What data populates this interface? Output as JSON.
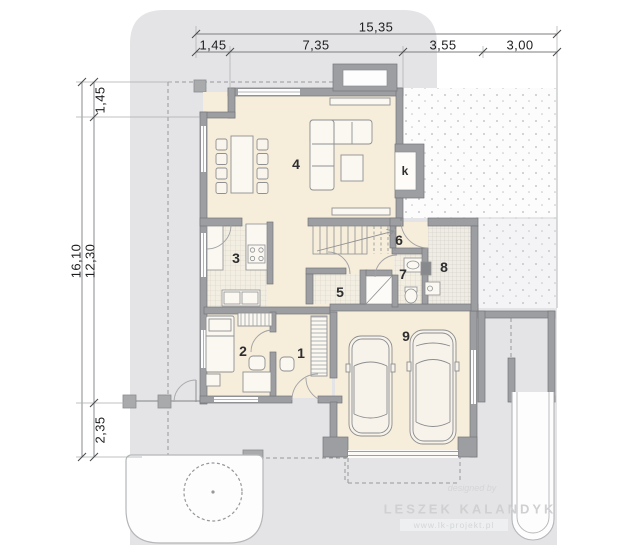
{
  "plan": {
    "dim_top": {
      "total": "15,35",
      "segments": [
        "1,45",
        "7,35",
        "3,55",
        "3,00"
      ]
    },
    "dim_left": {
      "total": "16,10",
      "upper": "1,45",
      "middle": "12,30",
      "lower": "2,35"
    },
    "rooms": [
      {
        "label": "1"
      },
      {
        "label": "2"
      },
      {
        "label": "3"
      },
      {
        "label": "4"
      },
      {
        "label": "5"
      },
      {
        "label": "6"
      },
      {
        "label": "7"
      },
      {
        "label": "8"
      },
      {
        "label": "9"
      }
    ],
    "fireplace_label": "k",
    "watermark": {
      "credit": "designed by",
      "author": "LESZEK KALANDYK",
      "website": "www.lk-projekt.pl"
    },
    "colors": {
      "plot": "#e4e4e6",
      "wall": "#9c9ea1",
      "floor": "#f6edda",
      "line": "#8e9093"
    }
  }
}
